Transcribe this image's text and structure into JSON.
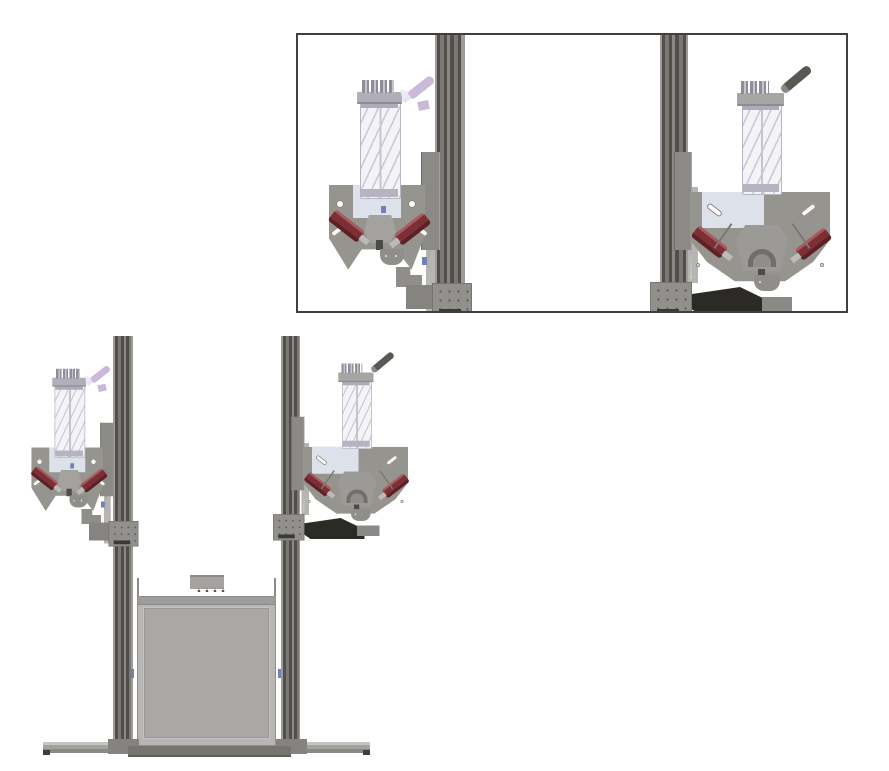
{
  "meta": {
    "description": "CAD technical figure: detail inset (top right) of two auger printhead assemblies on vertical rails, and full front view (bottom left) of the dual-printhead machine with build chamber and base feet.",
    "canvas": {
      "width": 889,
      "height": 771
    }
  },
  "colors": {
    "bg": "#ffffff",
    "insetBorder": "#3f3f3f",
    "railLight": "#9e9c98",
    "railMid": "#7a7874",
    "railDark": "#524f4b",
    "plate": "#96948f",
    "panel": "#dde1e9",
    "guide": "#b7b5b1",
    "cartBody": "#f4f3f6",
    "cartLine": "#c7c4d2",
    "cartSpiral": "#cac6d8",
    "cartCap": "#b0aeb8",
    "motor": "#7c2f34",
    "motorHi": "#a85a5e",
    "syringe": "#cbb9dc",
    "handle": "#5a5852",
    "scoop": "#2b2a27",
    "boxFrame": "#b7b6b4",
    "boxPanel": "#a9a8a6",
    "boxEdge": "#8f8e8c",
    "foot": "#a3a29f",
    "footDark": "#8a8986",
    "baseStrip": "#76756f",
    "endCap": "#3e3d3b",
    "carriage": "#91908c",
    "dot": "#62605d",
    "chip": "#3a3936",
    "latch": "#6f82b4"
  },
  "parts": {
    "inset": "Detail inset of the two printhead assemblies",
    "machine": "Front view of the dual-printhead machine",
    "zRail": "Vertical Z-axis rail",
    "linearGuide": "Linear guide rod",
    "carriageBracket": "Carriage bracket",
    "mountingPlate": "Printhead mounting plate",
    "plateWindow": "Plate back window",
    "cartridge": "Transparent material cartridge with auger",
    "cartridgeCap": "Cartridge cap",
    "syringe": "Dosing syringe",
    "handle": "Cartridge lever handle",
    "motorLeft": "Left dispensing motor",
    "motorRight": "Right dispensing motor",
    "mechanism": "Nozzle mechanism",
    "scoop": "Collector scoop",
    "railCarriage": "Rail carriage with screws",
    "buildChamber": "Build chamber",
    "topBracket": "Chamber top bracket",
    "baseFoot": "Base foot",
    "baseStrip": "Base strip",
    "column": "Support column"
  }
}
